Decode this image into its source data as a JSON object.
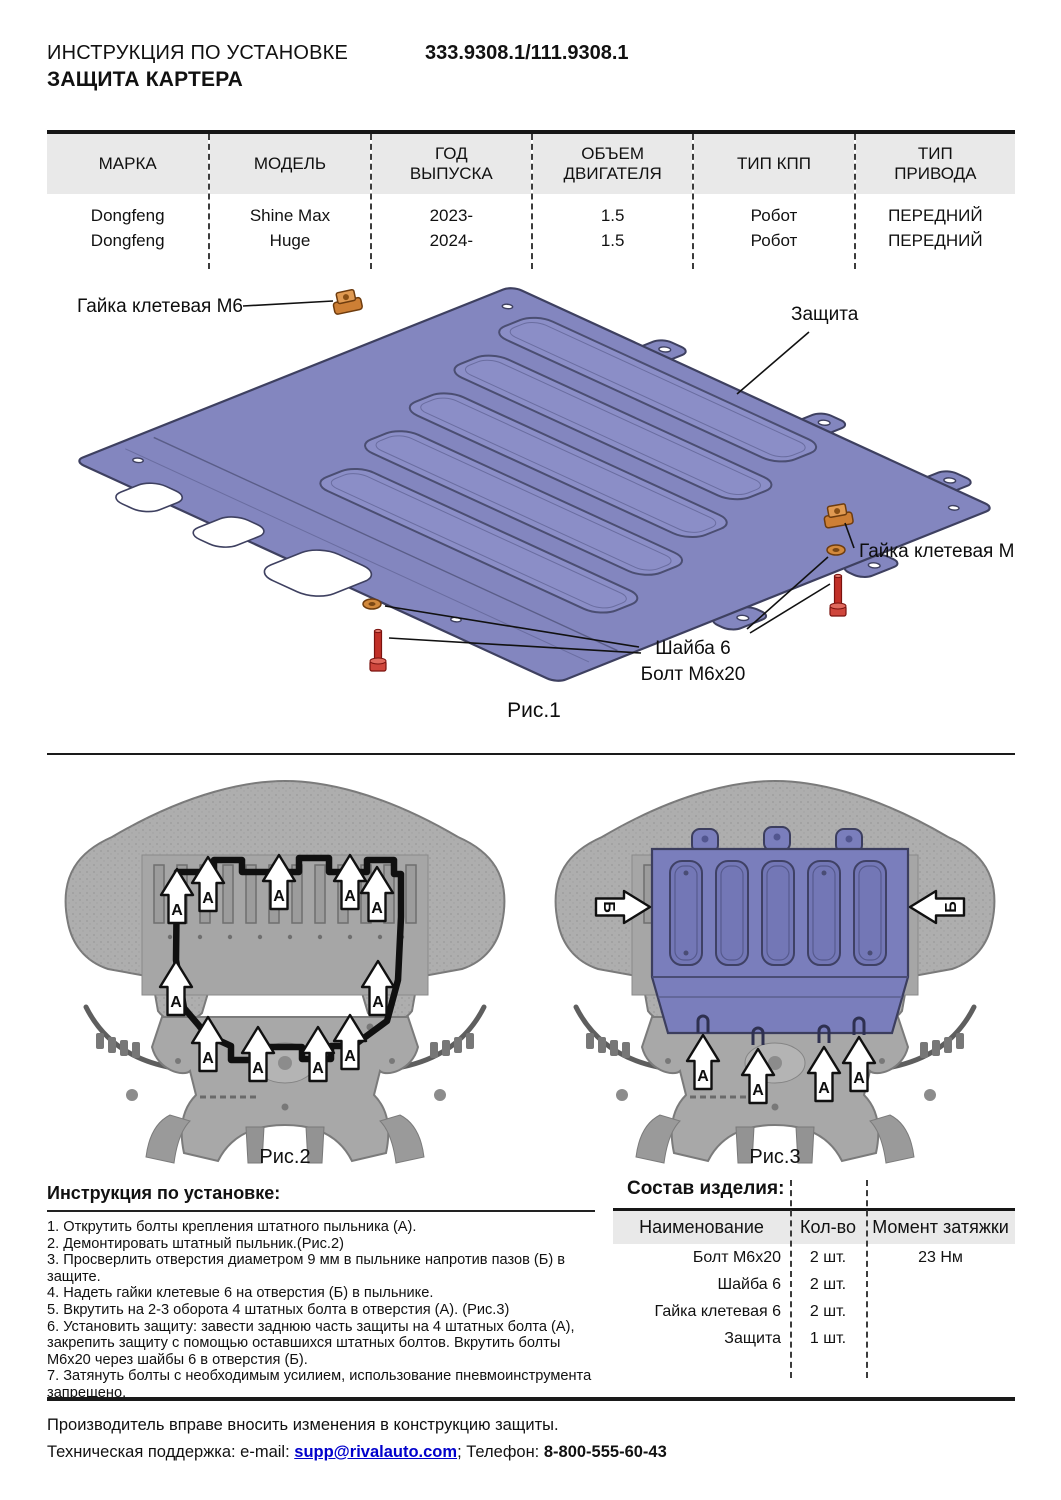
{
  "header": {
    "doc_type": "ИНСТРУКЦИЯ ПО УСТАНОВКЕ",
    "product": "ЗАЩИТА КАРТЕРА",
    "part_number": "333.9308.1/111.9308.1"
  },
  "fitment": {
    "headers": [
      [
        "МАРКА"
      ],
      [
        "МОДЕЛЬ"
      ],
      [
        "ГОД",
        "ВЫПУСКА"
      ],
      [
        "ОБЪЕМ",
        "ДВИГАТЕЛЯ"
      ],
      [
        "ТИП КПП"
      ],
      [
        "ТИП",
        "ПРИВОДА"
      ]
    ],
    "rows": [
      [
        "Dongfeng",
        "Shine Max",
        "2023-",
        "1.5",
        "Робот",
        "ПЕРЕДНИЙ"
      ],
      [
        "Dongfeng",
        "Huge",
        "2024-",
        "1.5",
        "Робот",
        "ПЕРЕДНИЙ"
      ]
    ]
  },
  "fig1": {
    "caption": "Рис.1",
    "label_clip_nut_top": "Гайка клетевая М6",
    "label_shield": "Защита",
    "label_clip_nut_right": "Гайка клетевая М6",
    "label_washer": "Шайба 6",
    "label_bolt": "Болт М6х20"
  },
  "fig2": {
    "caption": "Рис.2"
  },
  "fig3": {
    "caption": "Рис.3"
  },
  "arrows": {
    "a": "А",
    "b": "Б"
  },
  "instructions": {
    "title": "Инструкция по установке:",
    "steps": [
      "1. Открутить болты крепления штатного пыльника (А).",
      "2. Демонтировать штатный пыльник.(Рис.2)",
      "3. Просверлить отверстия диаметром 9 мм в пыльнике напротив пазов (Б) в защите.",
      "4. Надеть гайки клетевые 6 на отверстия (Б) в пыльнике.",
      "5. Вкрутить на 2-3 оборота 4 штатных болта в отверстия (А). (Рис.3)",
      "6. Установить защиту: завести заднюю часть защиты на 4 штатных болта (А), закрепить защиту с помощью оставшихся штатных болтов. Вкрутить болты М6х20 через шайбы 6 в отверстия (Б).",
      "7. Затянуть болты с необходимым усилием, использование пневмоинструмента запрещено."
    ]
  },
  "components": {
    "title": "Состав изделия:",
    "headers": [
      "Наименование",
      "Кол-во",
      "Момент затяжки"
    ],
    "rows": [
      [
        "Болт М6х20",
        "2 шт.",
        "23 Нм"
      ],
      [
        "Шайба 6",
        "2 шт.",
        ""
      ],
      [
        "Гайка клетевая 6",
        "2 шт.",
        ""
      ],
      [
        "Защита",
        "1 шт.",
        ""
      ]
    ]
  },
  "footer": {
    "note": "Производитель вправе вносить изменения в конструкцию защиты.",
    "support_prefix": "Техническая поддержка:  e-mail: ",
    "email": "supp@rivalauto.com",
    "separator": "; ",
    "phone_label": "Телефон: ",
    "phone": "8-800-555-60-43"
  },
  "colors": {
    "plate_purple": "#8386bf",
    "hardware_orange": "#cd7f35",
    "bolt_red": "#c13028",
    "link_blue": "#0000cc",
    "table_header_bg": "#e9e9e9"
  }
}
